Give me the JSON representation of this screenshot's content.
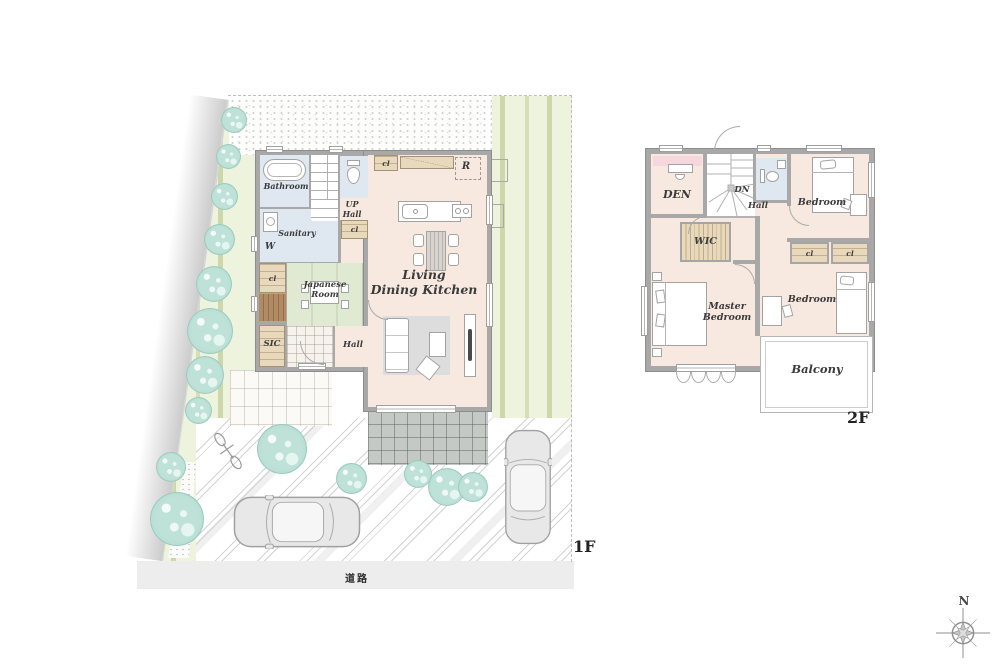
{
  "floor1": {
    "label": "1F",
    "road_label": "道路",
    "rooms": {
      "bathroom": {
        "label": "Bathroom"
      },
      "sanitary": {
        "label": "Sanitary",
        "washer": "W"
      },
      "stairs": {
        "line1": "UP",
        "line2": "Hall"
      },
      "closet_top": {
        "label": "cl"
      },
      "closet_mid": {
        "label": "cl"
      },
      "closet_left": {
        "label": "cl"
      },
      "refrigerator": {
        "label": "R"
      },
      "japanese_room": {
        "line1": "Japanese",
        "line2": "Room"
      },
      "sic": {
        "label": "SIC"
      },
      "hall": {
        "label": "Hall"
      },
      "ldk": {
        "line1": "Living",
        "line2": "Dining Kitchen"
      }
    }
  },
  "floor2": {
    "label": "2F",
    "rooms": {
      "den": {
        "label": "DEN"
      },
      "stairs": {
        "label": "DN"
      },
      "hall": {
        "label": "Hall"
      },
      "bedroom_north": {
        "label": "Bedroom"
      },
      "wic": {
        "label": "WIC"
      },
      "closet_a": {
        "label": "cl"
      },
      "closet_b": {
        "label": "cl"
      },
      "master_bedroom": {
        "line1": "Master",
        "line2": "Bedroom"
      },
      "bedroom_south": {
        "label": "Bedroom"
      },
      "balcony": {
        "label": "Balcony"
      }
    }
  },
  "compass": {
    "north": "N"
  },
  "colors": {
    "room_pink": "#f8e9e0",
    "wet_area_blue": "#dfe8f1",
    "tatami_green": "#e0e9d2",
    "closet_tan": "#e9d9bc",
    "wall_gray": "#a8a8a8",
    "lawn_green": "#eef3dd",
    "tree_green": "#b9ded3",
    "terrace_gray": "#c5c9c6",
    "accent_pink": "#f6d7de",
    "road_gray": "#ededed"
  }
}
